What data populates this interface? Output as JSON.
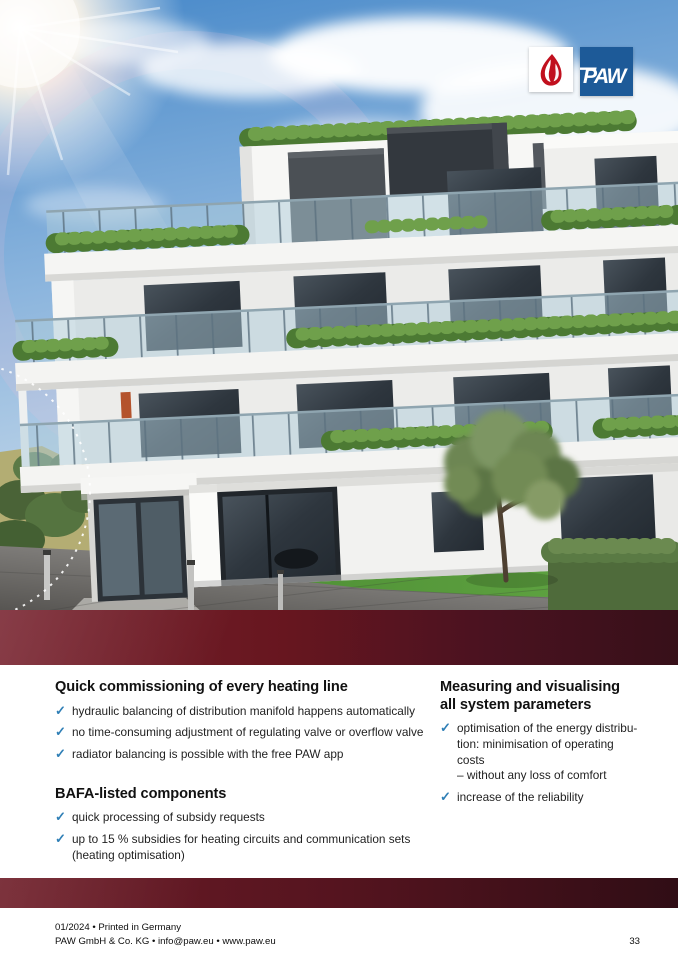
{
  "logo": {
    "wordmark": "PAW",
    "flame_icon": "flame-icon",
    "brand_blue": "#1d5a98",
    "flame_red": "#c1101e"
  },
  "icons": {
    "checkmark": "✓"
  },
  "colors": {
    "band_red_start": "#77222e",
    "band_red_end": "#371019",
    "check_blue": "#2f7fb6"
  },
  "content": {
    "left_column": {
      "sections": [
        {
          "heading": "Quick commissioning of every heating line",
          "items": [
            "hydraulic balancing of distribution manifold happens automatically",
            "no time-consuming adjustment of regulating valve or overflow valve",
            "radiator balancing is possible with the free PAW app"
          ]
        },
        {
          "heading": "BAFA-listed components",
          "items": [
            "quick processing of subsidy requests",
            "up to 15 % subsidies for heating circuits and communication sets\n(heating optimisation)"
          ]
        }
      ]
    },
    "right_column": {
      "sections": [
        {
          "heading": "Measuring and visualising\nall system parameters",
          "items": [
            "optimisation of the energy distribu-\ntion: minimisation of operating costs\n– without any loss of comfort",
            "increase of the reliability"
          ]
        }
      ]
    }
  },
  "footer": {
    "line1": "01/2024 • Printed in Germany",
    "line2": "PAW GmbH & Co. KG • info@paw.eu • www.paw.eu",
    "page_number": "33"
  }
}
